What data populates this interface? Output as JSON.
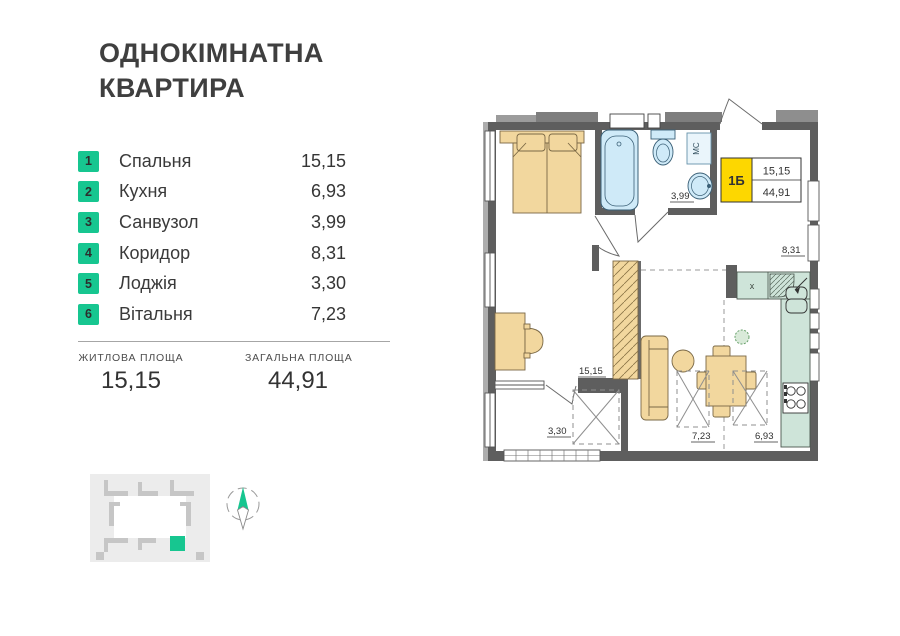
{
  "title": {
    "line1": "ОДНОКІМНАТНА",
    "line2": "КВАРТИРА"
  },
  "legend": [
    {
      "num": "1",
      "label": "Спальня",
      "area": "15,15"
    },
    {
      "num": "2",
      "label": "Кухня",
      "area": "6,93"
    },
    {
      "num": "3",
      "label": "Санвузол",
      "area": "3,99"
    },
    {
      "num": "4",
      "label": "Коридор",
      "area": "8,31"
    },
    {
      "num": "5",
      "label": "Лоджія",
      "area": "3,30"
    },
    {
      "num": "6",
      "label": "Вітальня",
      "area": "7,23"
    }
  ],
  "summary": {
    "living_label": "ЖИТЛОВА ПЛОЩА",
    "living_value": "15,15",
    "total_label": "ЗАГАЛЬНА ПЛОЩА",
    "total_value": "44,91"
  },
  "plan": {
    "badge": {
      "code": "1Б",
      "living": "15,15",
      "total": "44,91"
    },
    "labels": {
      "bedroom": "15,15",
      "kitchen": "6,93",
      "bathroom": "3,99",
      "corridor": "8,31",
      "loggia": "3,30",
      "living": "7,23"
    },
    "washer": "МС",
    "cabinet": "x"
  },
  "colors": {
    "accent": "#17c690",
    "badge_yellow": "#fdd700",
    "walls": "#5e5e5e",
    "furniture": "#f2d79e",
    "fixtures": "#cfeaf8",
    "kitchen_counter": "#cee4d9"
  }
}
